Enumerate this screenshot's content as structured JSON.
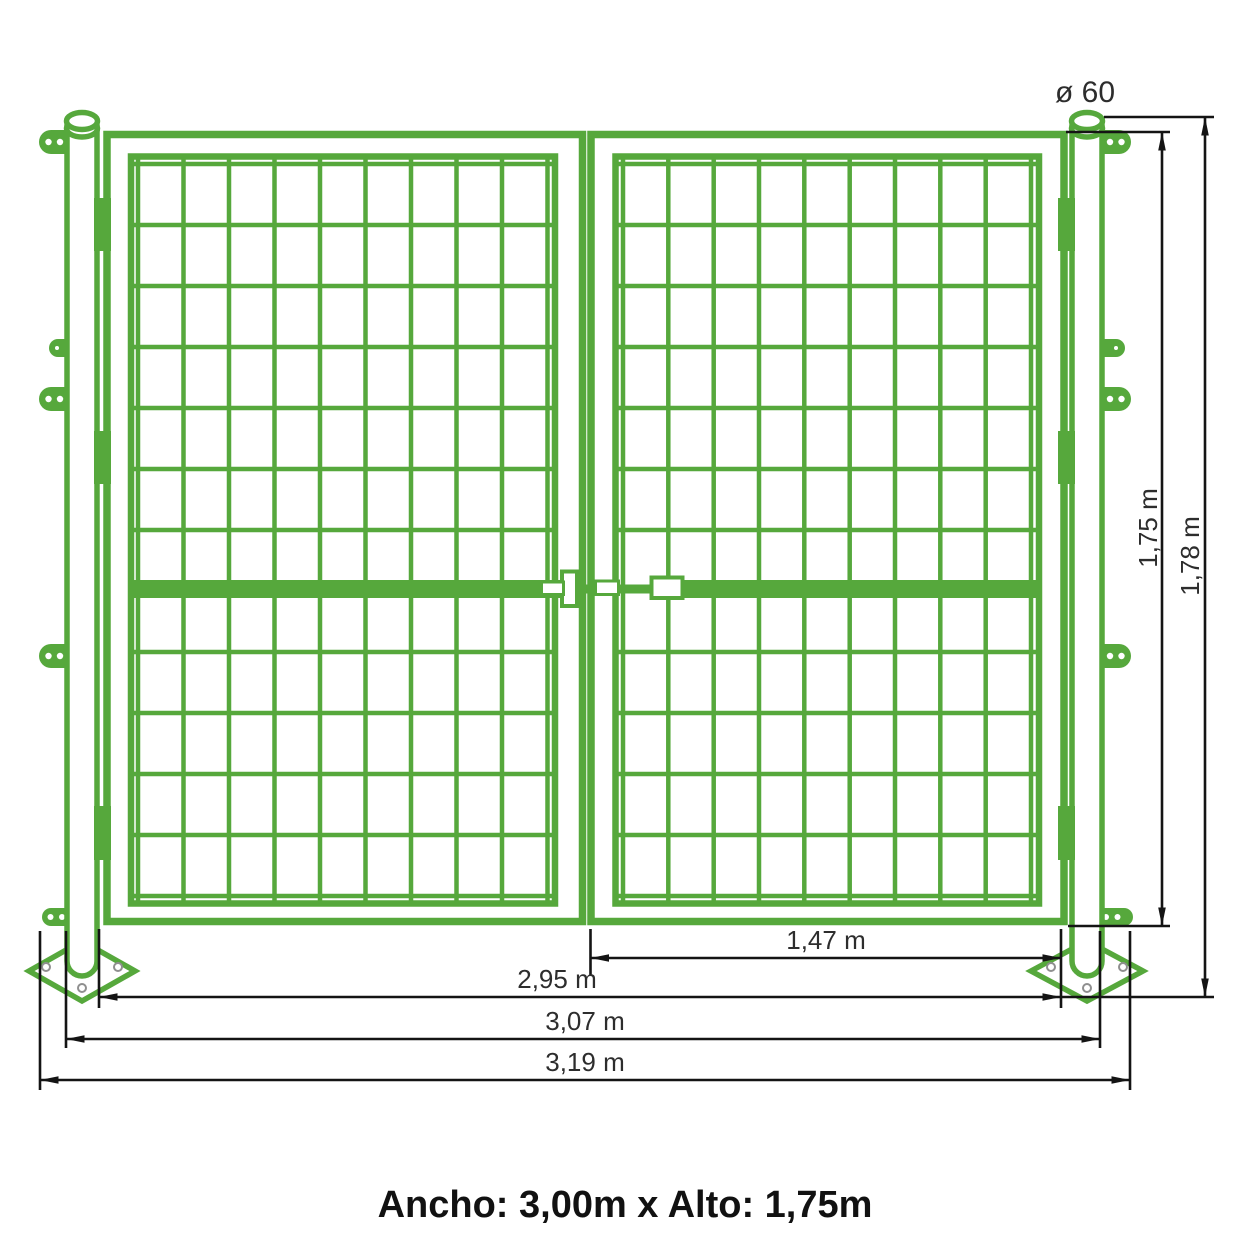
{
  "caption": "Ancho: 3,00m x Alto: 1,75m",
  "dimensions": {
    "post_diameter": "ø 60",
    "gate_height": "1,75 m",
    "post_height": "1,78 m",
    "leaf_width": "1,47 m",
    "clear_width": "2,95 m",
    "outer_post_width": "3,07 m",
    "total_width": "3,19 m"
  },
  "colors": {
    "gate_green": "#56a83c",
    "dimension_line": "#141414",
    "dimension_text": "#2d2d2d",
    "caption_text": "#111111",
    "plate_hole_gray": "#8f8f8f",
    "background": "#ffffff"
  }
}
